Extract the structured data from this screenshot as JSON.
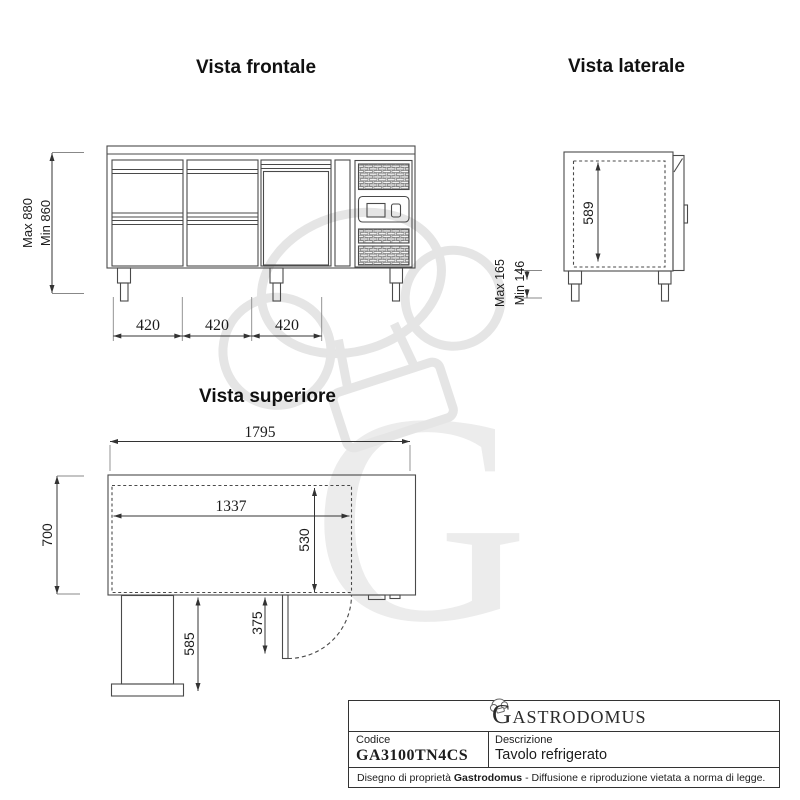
{
  "colors": {
    "line": "#4a4a4a",
    "dim_line": "#333333",
    "watermark": "#ececec",
    "text": "#1c1c1c"
  },
  "front_view": {
    "title": "Vista frontale",
    "dim_height_max": "Max 880",
    "dim_height_min": "Min 860",
    "dim_widths": [
      "420",
      "420",
      "420"
    ]
  },
  "side_view": {
    "title": "Vista laterale",
    "dim_depth": "589",
    "dim_leg_max": "Max 165",
    "dim_leg_min": "Min 146"
  },
  "top_view": {
    "title": "Vista superiore",
    "dim_total_width": "1795",
    "dim_inner_width": "1337",
    "dim_depth": "700",
    "dim_inner_depth": "530",
    "dim_left_section": "585",
    "dim_door": "375"
  },
  "title_block": {
    "brand_initial": "G",
    "brand_rest": "ASTRODOMUS",
    "code_label": "Codice",
    "code_value": "GA3100TN4CS",
    "description_label": "Descrizione",
    "description_value": "Tavolo refrigerato",
    "footer_prefix": "Disegno di proprietà ",
    "footer_brand": "Gastrodomus",
    "footer_suffix": " - Diffusione e riproduzione vietata a norma di legge."
  }
}
